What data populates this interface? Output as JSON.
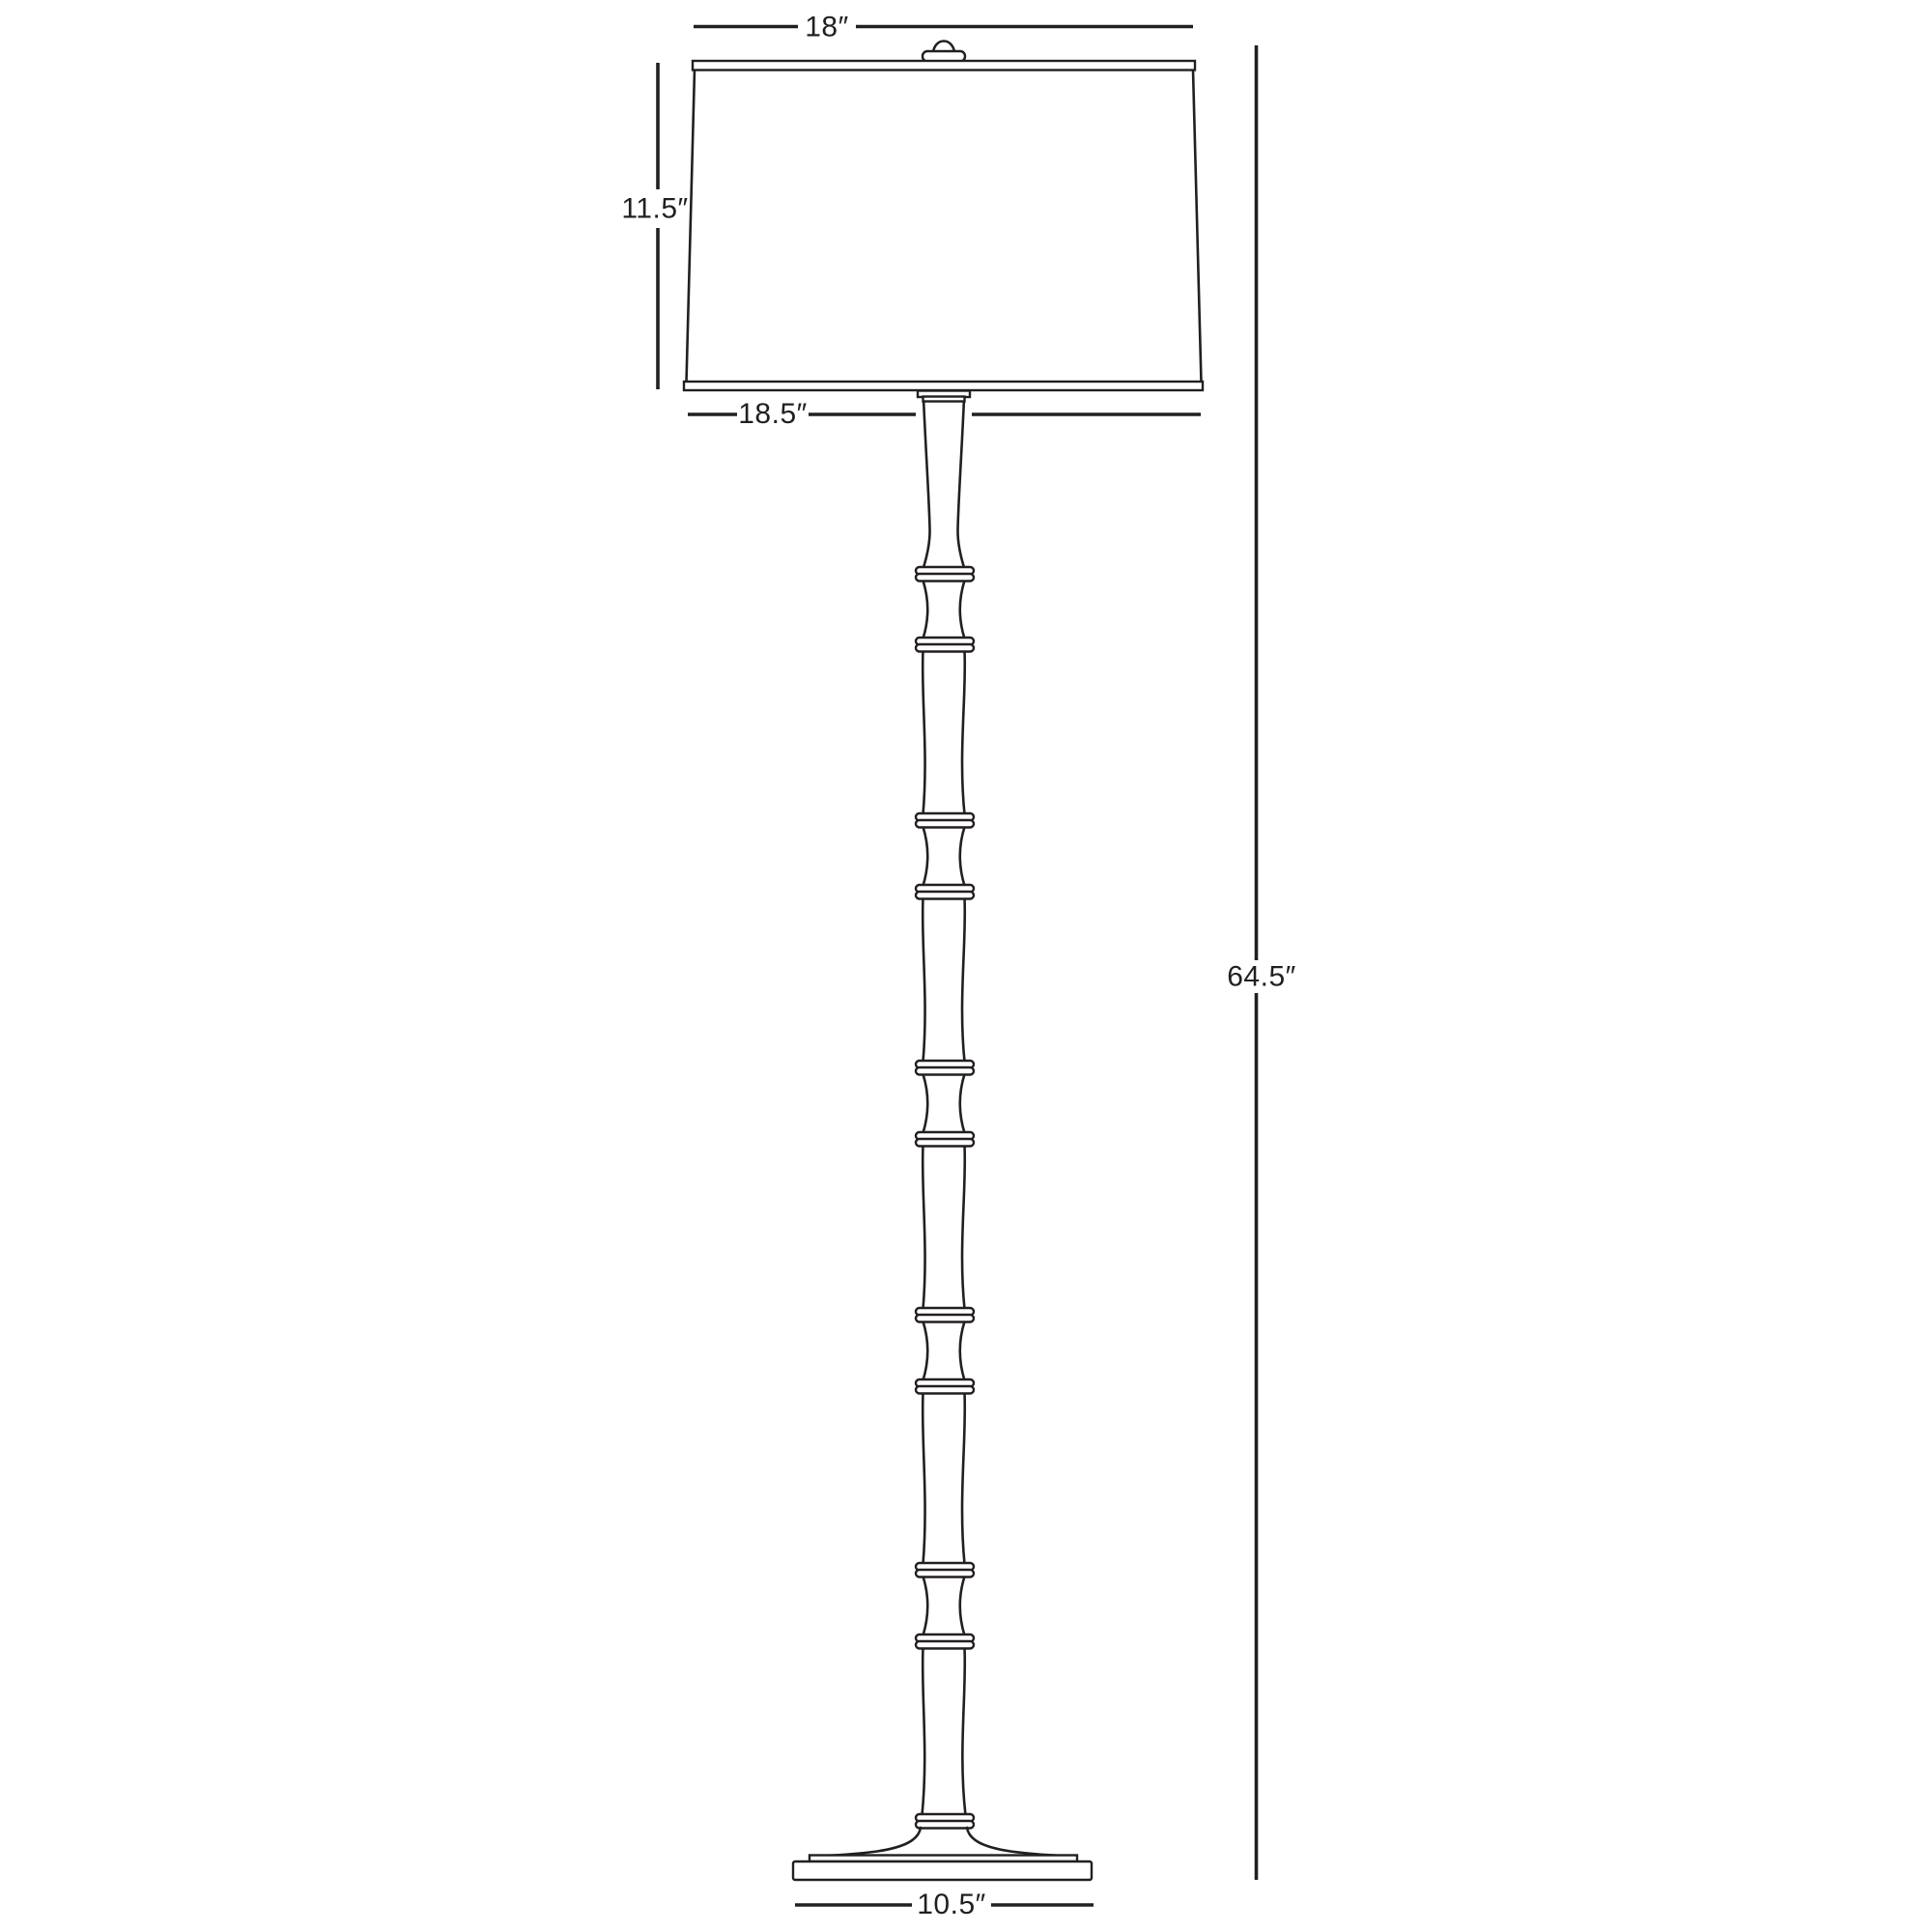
{
  "diagram": {
    "background_color": "#ffffff",
    "line_color": "#231f20",
    "labels": {
      "shade_top_width": "18″",
      "shade_height": "11.5″",
      "shade_bottom_width": "18.5″",
      "overall_height": "64.5″",
      "base_width": "10.5″"
    }
  }
}
